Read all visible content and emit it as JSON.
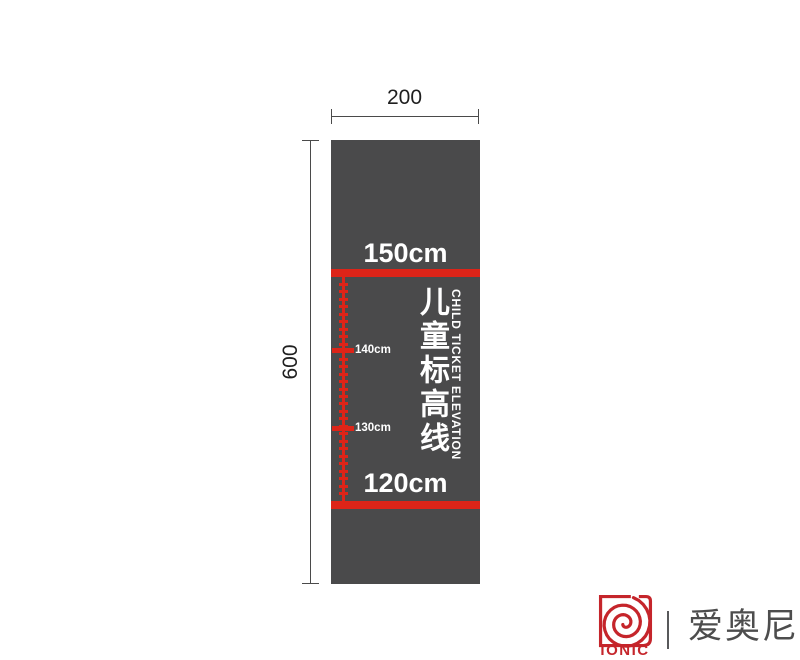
{
  "colors": {
    "red": "#dd2418",
    "logo_red": "#c5252b",
    "panel_gray": "#4a4a4b",
    "dim_line": "#4a4a4a",
    "text_white": "#ffffff",
    "brand_gray": "#4d4d4d"
  },
  "dimensions": {
    "width_label": "200",
    "height_label": "600"
  },
  "sign": {
    "top_line_label": "150cm",
    "bottom_line_label": "120cm",
    "title_cn": "儿童标高线",
    "title_en": "CHILD TICKET ELEVATION",
    "ruler": {
      "top_cm": 150,
      "bottom_cm": 120,
      "major_labels": [
        "140cm",
        "130cm"
      ]
    }
  },
  "brand": {
    "logo_text": "IONIC",
    "brand_cn": "爱奥尼",
    "logo_icon": "spiral-logo"
  }
}
